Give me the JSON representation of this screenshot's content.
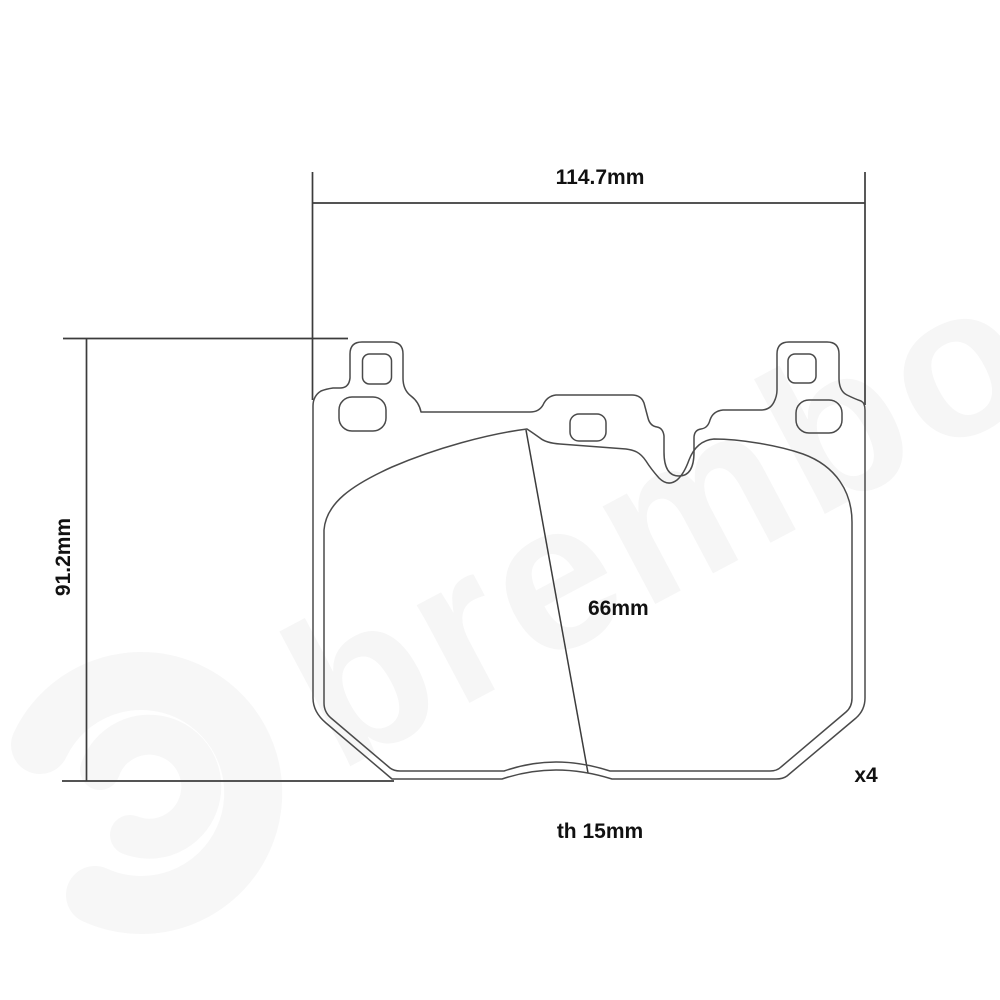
{
  "drawing": {
    "type": "brake-pad-technical-drawing",
    "labels": {
      "width": "114.7mm",
      "height": "91.2mm",
      "pad_height": "66mm",
      "thickness": "th 15mm",
      "quantity": "x4"
    }
  },
  "watermark": {
    "text": "brembo"
  },
  "colors": {
    "outline": "#4a4a4a",
    "dimension_line": "#3c3c3c",
    "label_text": "#111111",
    "watermark": "#f6f6f6",
    "background": "#ffffff"
  }
}
